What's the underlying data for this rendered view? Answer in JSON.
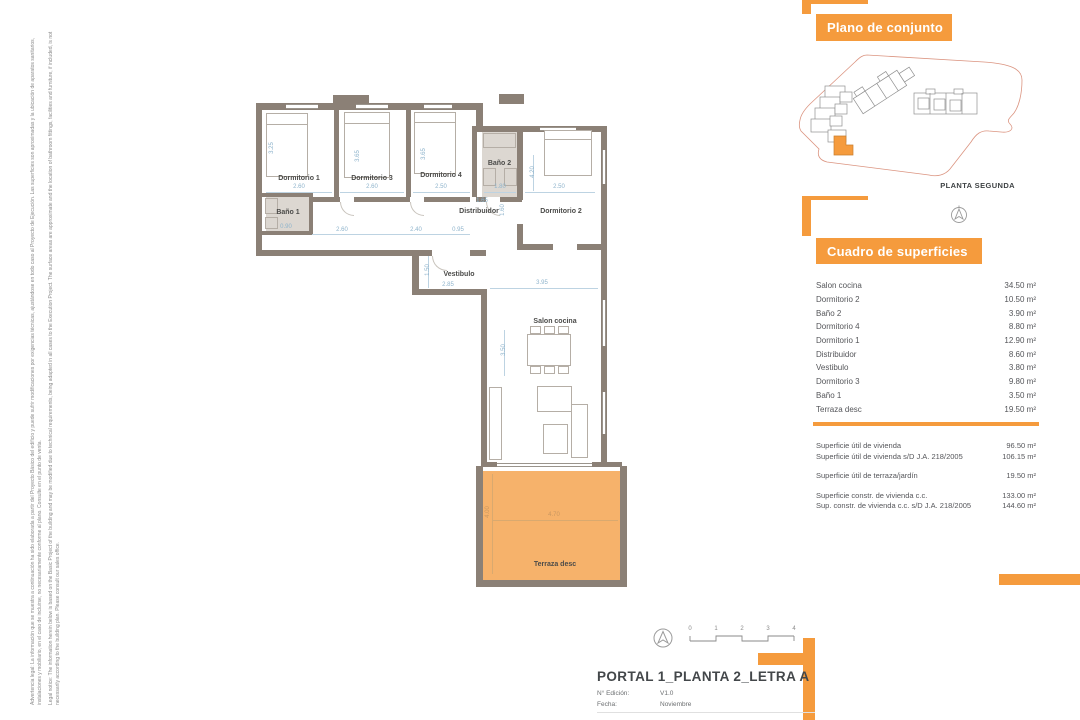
{
  "legal": {
    "es": "Advertencia legal: La información que se muestra a continuación ha sido elaborada a partir del Proyecto Básico del edificio y puede sufrir modificaciones por exigencias técnicas, ajustándose en todo caso al Proyecto de Ejecución. Las superficies son aproximadas y la ubicación de aparatos sanitarios, instalaciones y mobiliario, en el caso de incluirse, no necesariamente conforme al plano. Consulte en el punto de venta.",
    "en": "Legal notice: The information herein below is based on the Basic Project of the building and may be modified due to technical requirements, being adapted in all cases to the Execution Project. The surface areas are approximate and the location of bathroom fittings, facilities and furniture, if included, is not necessarily according to the building plan. Please consult our sales office."
  },
  "site_panel": {
    "title": "Plano de conjunto",
    "caption": "PLANTA SEGUNDA"
  },
  "surfaces_panel": {
    "title": "Cuadro de superficies",
    "rows": [
      [
        "Salon cocina",
        "34.50 m²"
      ],
      [
        "Dormitorio 2",
        "10.50 m²"
      ],
      [
        "Baño 2",
        "3.90 m²"
      ],
      [
        "Dormitorio 4",
        "8.80 m²"
      ],
      [
        "Dormitorio 1",
        "12.90 m²"
      ],
      [
        "Distribuidor",
        "8.60 m²"
      ],
      [
        "Vestibulo",
        "3.80 m²"
      ],
      [
        "Dormitorio 3",
        "9.80 m²"
      ],
      [
        "Baño 1",
        "3.50 m²"
      ],
      [
        "Terraza desc",
        "19.50 m²"
      ]
    ],
    "summary_groups": [
      [
        [
          "Superficie útil de vivienda",
          "96.50 m²"
        ],
        [
          "Superficie útil de vivienda s/D J.A. 218/2005",
          "106.15 m²"
        ]
      ],
      [
        [
          "Superficie útil de terraza/jardín",
          "19.50 m²"
        ]
      ],
      [
        [
          "Superficie constr. de vivienda c.c.",
          "133.00 m²"
        ],
        [
          "Sup. constr. de vivienda c.c. s/D J.A. 218/2005",
          "144.60 m²"
        ]
      ]
    ]
  },
  "title_block": {
    "title": "PORTAL 1_PLANTA 2_LETRA A",
    "edition_label": "N° Edición:",
    "edition_value": "V1.0",
    "date_label": "Fecha:",
    "date_value": "Noviembre"
  },
  "scale_bar": {
    "ticks": [
      "0",
      "1",
      "2",
      "3",
      "4"
    ]
  },
  "floor_plan": {
    "rooms": {
      "dormitorio1": {
        "label": "Dormitorio 1",
        "w": "2.60",
        "h": "3.25"
      },
      "dormitorio3": {
        "label": "Dormitorio 3",
        "w": "2.60",
        "h": "3.65"
      },
      "dormitorio4": {
        "label": "Dormitorio 4",
        "w": "2.50",
        "h": "3.65"
      },
      "dormitorio2": {
        "label": "Dormitorio 2",
        "w": "2.50",
        "h": "4.20"
      },
      "bano1": {
        "label": "Baño 1",
        "w": "0.90"
      },
      "bano2": {
        "label": "Baño 2",
        "w": "1.80"
      },
      "distribuidor": {
        "label": "Distribuidor",
        "d1": "2.60",
        "d2": "2.40",
        "d3": "0.95",
        "d4": "1.65",
        "d5": "1.60"
      },
      "vestibulo": {
        "label": "Vestibulo",
        "w": "2.85",
        "h": "1.50"
      },
      "salon": {
        "label": "Salon cocina",
        "w": "3.95",
        "h": "3.50"
      },
      "terraza": {
        "label": "Terraza desc",
        "w": "4.70",
        "h": "4.00"
      }
    }
  },
  "colors": {
    "accent": "#F59B3D",
    "wall": "#8B8076",
    "terrace_fill": "#F6B26B",
    "dimension_text": "#8FB4CC"
  }
}
